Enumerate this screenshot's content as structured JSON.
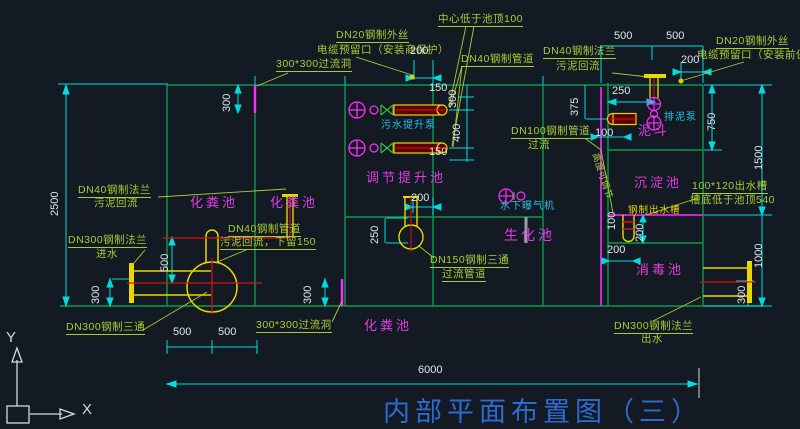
{
  "window": {
    "background": "#131a23"
  },
  "colors": {
    "wall_green": "#0a9a4e",
    "label_green": "#a9cc35",
    "dim_cyan": "#00dcdc",
    "dim_text": "#dfe5ea",
    "room_magenta": "#e03ce0",
    "hole_magenta": "#ff2bff",
    "pipe_yellow": "#e8d800",
    "pipe_red": "#e01010",
    "equip_cyan": "#1fc4e8",
    "title_blue": "#2e6bd0"
  },
  "title": {
    "text": "内部平面布置图（三）"
  },
  "axis": {
    "x": "X",
    "y": "Y"
  },
  "rooms": {
    "septic1": "化粪池",
    "septic2": "化粪池",
    "septic3": "化粪池",
    "regulating": "调节提升池",
    "bio": "生化池",
    "sediment": "沉淀池",
    "hopper": "泥斗",
    "disinfect": "消毒池"
  },
  "equipment": {
    "sewage_pump": "污水提升泵",
    "aerator": "水下曝气机",
    "mud_pump": "排泥泵",
    "outlet_channel": "钢制出水槽"
  },
  "labels": {
    "center_note": "中心低于池顶100",
    "dn20_left_1": "DN20钢制外丝",
    "dn20_left_2": "电缆预留口（安装商保护）",
    "overflow_top": "300*300过流洞",
    "dn40_pipe": "DN40钢制管道",
    "dn40_flange_r1": "DN40钢制法兰",
    "dn40_flange_r2": "污泥回流",
    "dn20_right_1": "DN20钢制外丝",
    "dn20_right_2": "电缆预留口（安装前保护）",
    "dn100_1": "DN100钢制管道",
    "dn100_2": "过流",
    "rot_note": "高度可调节",
    "dn40_flange_l1": "DN40钢制法兰",
    "dn40_flange_l2": "污泥回流",
    "dn300_in_1": "DN300钢制法兰",
    "dn300_in_2": "进水",
    "dn40_ret_1": "DN40钢制管道",
    "dn40_ret_2": "污泥回流，下留150",
    "dn150_1": "DN150钢制三通",
    "dn150_2": "过流管道",
    "out_channel_1": "100*120出水槽",
    "out_channel_2": "槽底低于池顶540",
    "dn300_tee": "DN300钢制三通",
    "overflow_bottom": "300*300过流洞",
    "dn300_out_1": "DN300钢制法兰",
    "dn300_out_2": "出水"
  },
  "dims": {
    "d200_dn20l": "200",
    "d200_dn20r": "200",
    "d500_top_a": "500",
    "d500_top_b": "500",
    "d375": "375",
    "d250_hopper": "250",
    "d750": "750",
    "d1500": "1500",
    "d100_hopper": "100",
    "d300_tl": "300",
    "d2500": "2500",
    "d150_p1": "150",
    "d300_p": "300",
    "d400_p": "400",
    "d150_p2": "150",
    "d200_pump": "200",
    "d500_left": "500",
    "d250_tee": "250",
    "d100_weir": "100",
    "d200_weir": "200",
    "d200_weir_b": "200",
    "d1000": "1000",
    "d300_out": "300",
    "d300_bl1": "300",
    "d300_bl2": "300",
    "d500_bot_a": "500",
    "d500_bot_b": "500",
    "d6000": "6000"
  }
}
